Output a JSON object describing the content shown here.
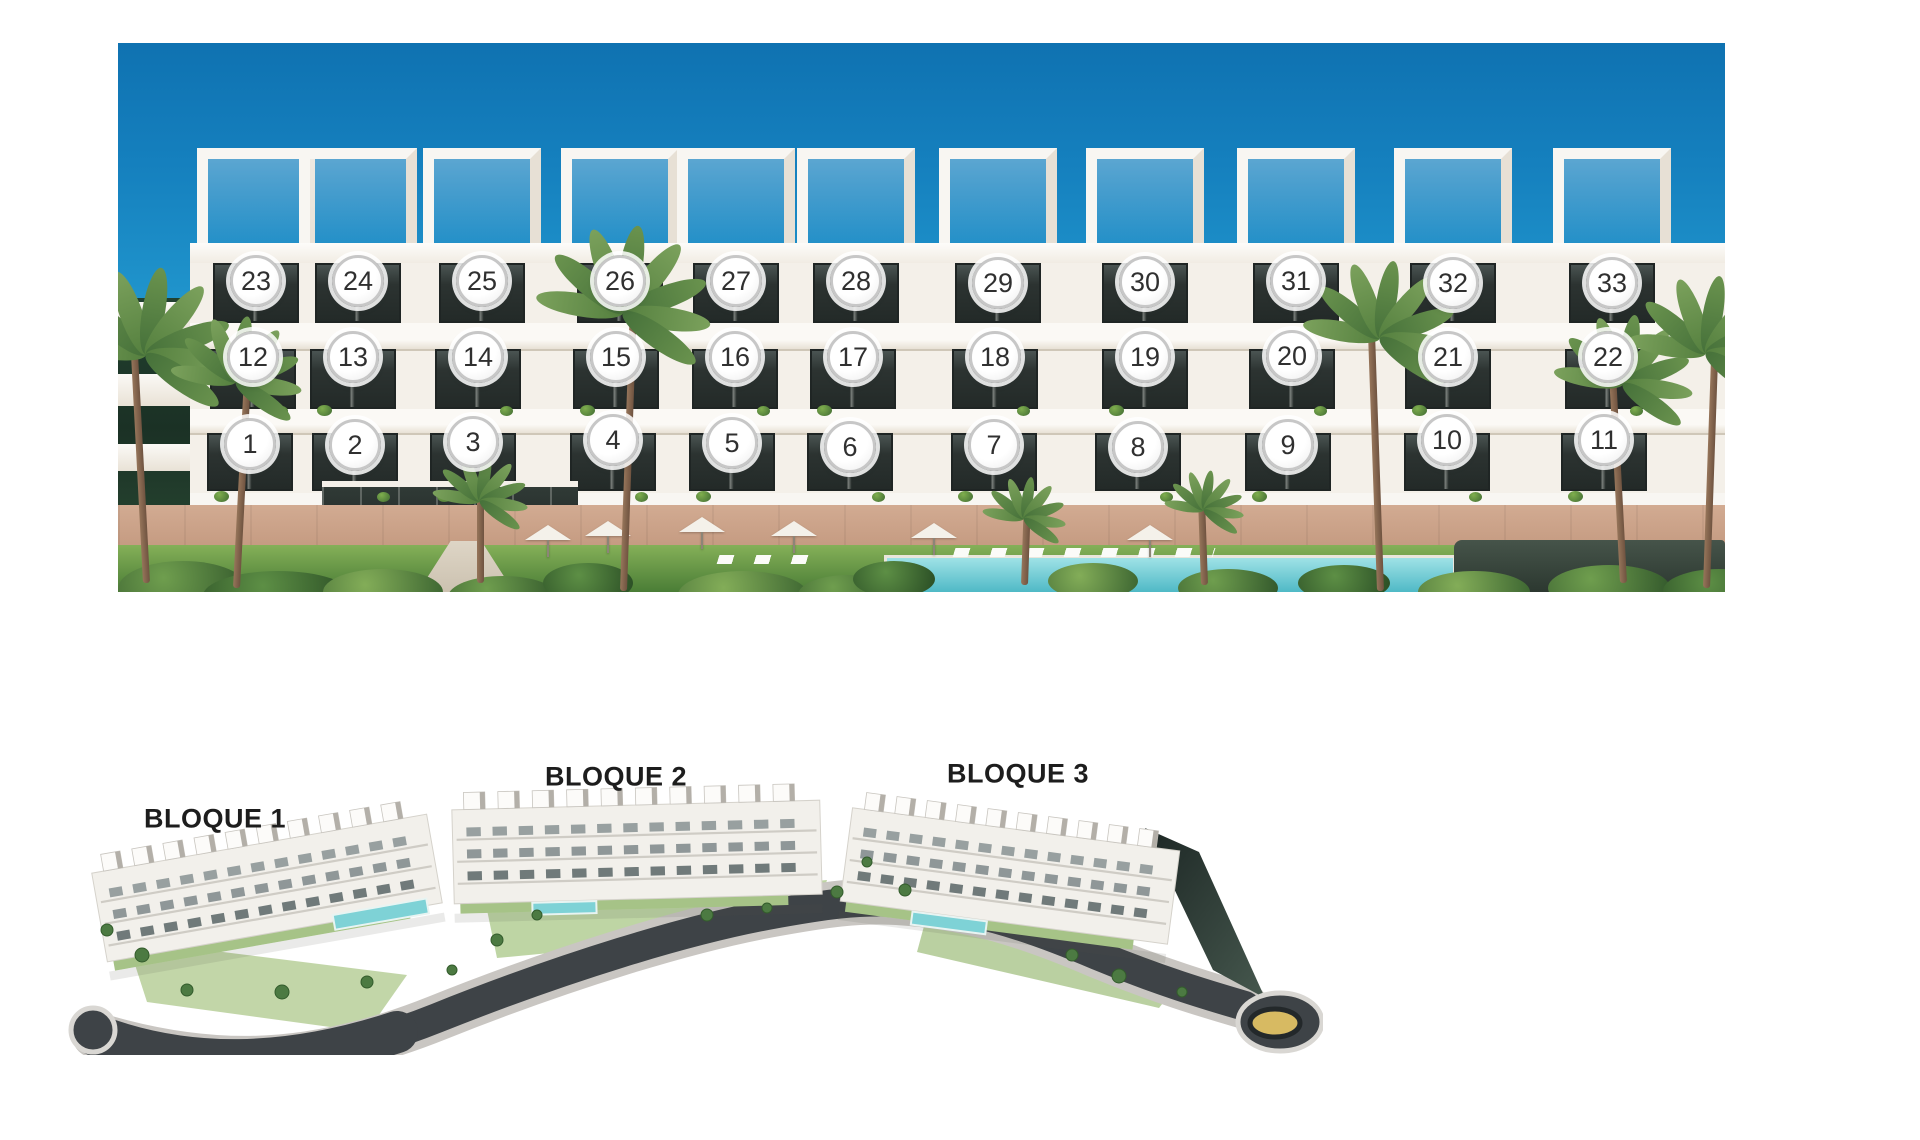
{
  "elevation": {
    "units": [
      {
        "label": "1",
        "x": 250,
        "y": 444
      },
      {
        "label": "2",
        "x": 355,
        "y": 445
      },
      {
        "label": "3",
        "x": 473,
        "y": 442
      },
      {
        "label": "4",
        "x": 613,
        "y": 440
      },
      {
        "label": "5",
        "x": 732,
        "y": 443
      },
      {
        "label": "6",
        "x": 850,
        "y": 447
      },
      {
        "label": "7",
        "x": 994,
        "y": 445
      },
      {
        "label": "8",
        "x": 1138,
        "y": 447
      },
      {
        "label": "9",
        "x": 1288,
        "y": 445
      },
      {
        "label": "10",
        "x": 1447,
        "y": 440
      },
      {
        "label": "11",
        "x": 1604,
        "y": 440
      },
      {
        "label": "12",
        "x": 253,
        "y": 357
      },
      {
        "label": "13",
        "x": 353,
        "y": 357
      },
      {
        "label": "14",
        "x": 478,
        "y": 357
      },
      {
        "label": "15",
        "x": 616,
        "y": 357
      },
      {
        "label": "16",
        "x": 735,
        "y": 357
      },
      {
        "label": "17",
        "x": 853,
        "y": 357
      },
      {
        "label": "18",
        "x": 995,
        "y": 357
      },
      {
        "label": "19",
        "x": 1145,
        "y": 357
      },
      {
        "label": "20",
        "x": 1292,
        "y": 356
      },
      {
        "label": "21",
        "x": 1448,
        "y": 357
      },
      {
        "label": "22",
        "x": 1608,
        "y": 357
      },
      {
        "label": "23",
        "x": 256,
        "y": 281
      },
      {
        "label": "24",
        "x": 358,
        "y": 281
      },
      {
        "label": "25",
        "x": 482,
        "y": 281
      },
      {
        "label": "26",
        "x": 620,
        "y": 281
      },
      {
        "label": "27",
        "x": 736,
        "y": 281
      },
      {
        "label": "28",
        "x": 856,
        "y": 281
      },
      {
        "label": "29",
        "x": 998,
        "y": 283
      },
      {
        "label": "30",
        "x": 1145,
        "y": 282
      },
      {
        "label": "31",
        "x": 1296,
        "y": 281
      },
      {
        "label": "32",
        "x": 1453,
        "y": 283
      },
      {
        "label": "33",
        "x": 1612,
        "y": 283
      }
    ],
    "marker_style": {
      "fill": "#ffffff",
      "ring": "#c7c7c7",
      "text_color": "#303030"
    }
  },
  "site_plan": {
    "block_labels": [
      {
        "text": "BLOQUE 1",
        "x": 215,
        "y": 819
      },
      {
        "text": "BLOQUE 2",
        "x": 616,
        "y": 777
      },
      {
        "text": "BLOQUE 3",
        "x": 1018,
        "y": 774
      }
    ],
    "label_color": "#1d1d1d"
  },
  "colors": {
    "sky_top": "#0f72b1",
    "sky_horizon": "#a5e0ec",
    "pool": "#4fb9c6",
    "lawn": "#4a7d36",
    "road": "#3e4347",
    "roundabout_center": "#d7ba62",
    "base_wall": "#c49c82"
  }
}
